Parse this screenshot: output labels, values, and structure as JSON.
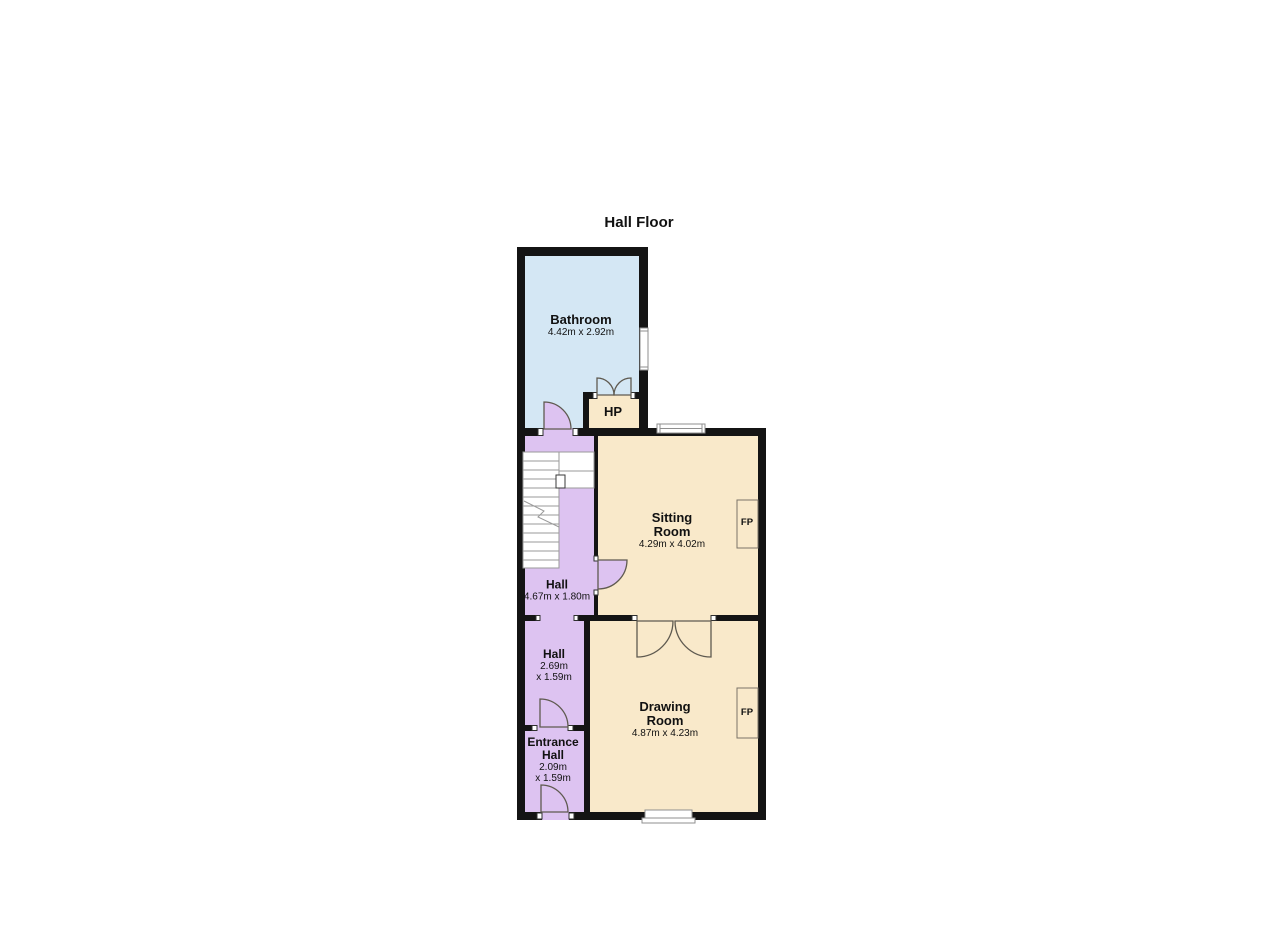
{
  "title": "Hall Floor",
  "colors": {
    "background": "#ffffff",
    "wall": "#141414",
    "bathroom": "#d4e7f4",
    "halls": "#ddc3f1",
    "rooms_cream": "#f9e9ca",
    "door_lines": "#5f5a50",
    "window_lines": "#8f8f8f",
    "stair_lines": "#9a9a9a",
    "text": "#111111"
  },
  "rooms": {
    "bathroom": {
      "name": "Bathroom",
      "dims": "4.42m x 2.92m"
    },
    "hp": {
      "name": "HP"
    },
    "sitting": {
      "name1": "Sitting",
      "name2": "Room",
      "dims": "4.29m x 4.02m"
    },
    "hall_upper": {
      "name": "Hall",
      "dims": "4.67m x 1.80m"
    },
    "hall_lower": {
      "name": "Hall",
      "dims1": "2.69m",
      "dims2": "x 1.59m"
    },
    "entrance": {
      "name1": "Entrance",
      "name2": "Hall",
      "dims1": "2.09m",
      "dims2": "x 1.59m"
    },
    "drawing": {
      "name1": "Drawing",
      "name2": "Room",
      "dims": "4.87m x 4.23m"
    },
    "fireplace": {
      "label": "FP"
    }
  }
}
